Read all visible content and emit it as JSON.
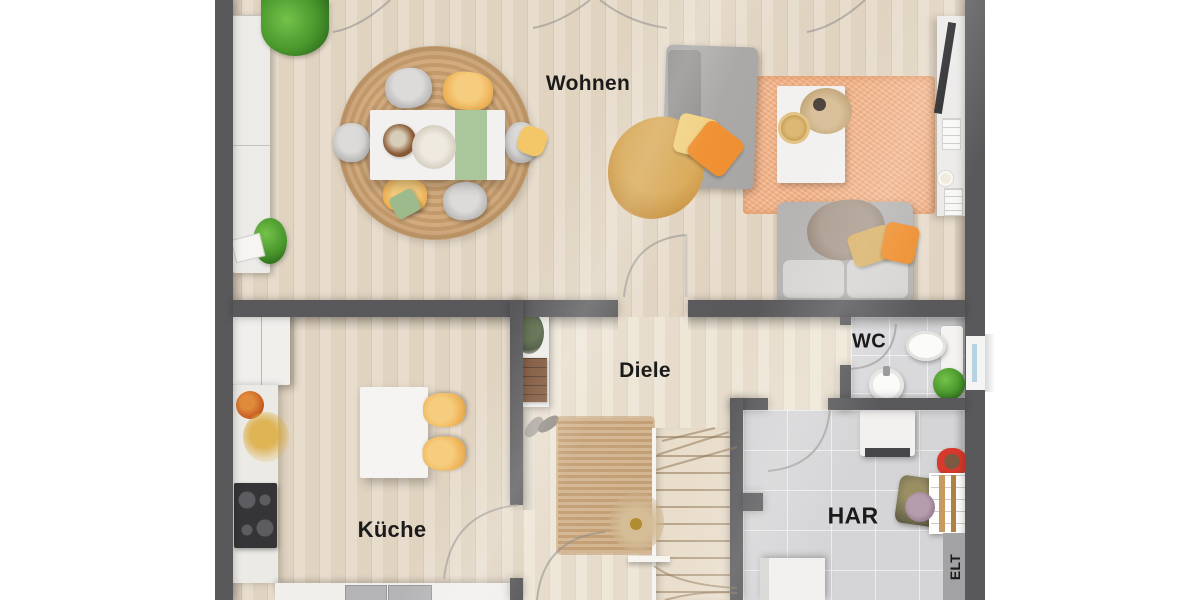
{
  "scene": {
    "kind": "residential floor plan, top-down 3D render",
    "language": "de"
  },
  "rooms": [
    {
      "id": "wohnen",
      "label": "Wohnen"
    },
    {
      "id": "kueche",
      "label": "Küche"
    },
    {
      "id": "diele",
      "label": "Diele"
    },
    {
      "id": "wc",
      "label": "WC"
    },
    {
      "id": "har",
      "label": "HAR"
    },
    {
      "id": "elt",
      "label": "ELT"
    }
  ],
  "colors": {
    "wall": "#59595b",
    "wood_floor": "#e5d9c7",
    "hall_floor": "#ece2d2",
    "tile_floor": "#d9d9db",
    "jute_rug": "#cba77c",
    "orange_rug": "#f0b086",
    "accent_yellow": "#eeb257",
    "accent_orange": "#ee8e2e",
    "accent_green": "#a9c79a",
    "plant_green": "#49962c",
    "red_caddy": "#d8392c",
    "label_text": "#1b1b1b"
  },
  "furniture": {
    "wohnen": [
      "wardrobe",
      "fern-plant",
      "round-jute-rug",
      "dining-table",
      "table-runner",
      "dining-chairs",
      "chaise-sofa",
      "throw-blanket",
      "pillows",
      "orange-area-rug",
      "coffee-table",
      "pampas-vase",
      "sofa",
      "tv-sideboard",
      "tv"
    ],
    "kueche": [
      "tall-cabinet",
      "side-counter",
      "cooktop",
      "bottom-counter",
      "double-sink",
      "island-table",
      "bar-chairs",
      "fruit-bowl",
      "dried-flowers"
    ],
    "diele": [
      "wall-shelf",
      "shoes",
      "runner-rug",
      "staircase",
      "dried-plant"
    ],
    "wc": [
      "toilet",
      "washbasin",
      "plant",
      "window"
    ],
    "har": [
      "water-heater",
      "red-caddy",
      "shelf-rack",
      "laundry-basket",
      "washing-machine",
      "elt-panel"
    ]
  }
}
